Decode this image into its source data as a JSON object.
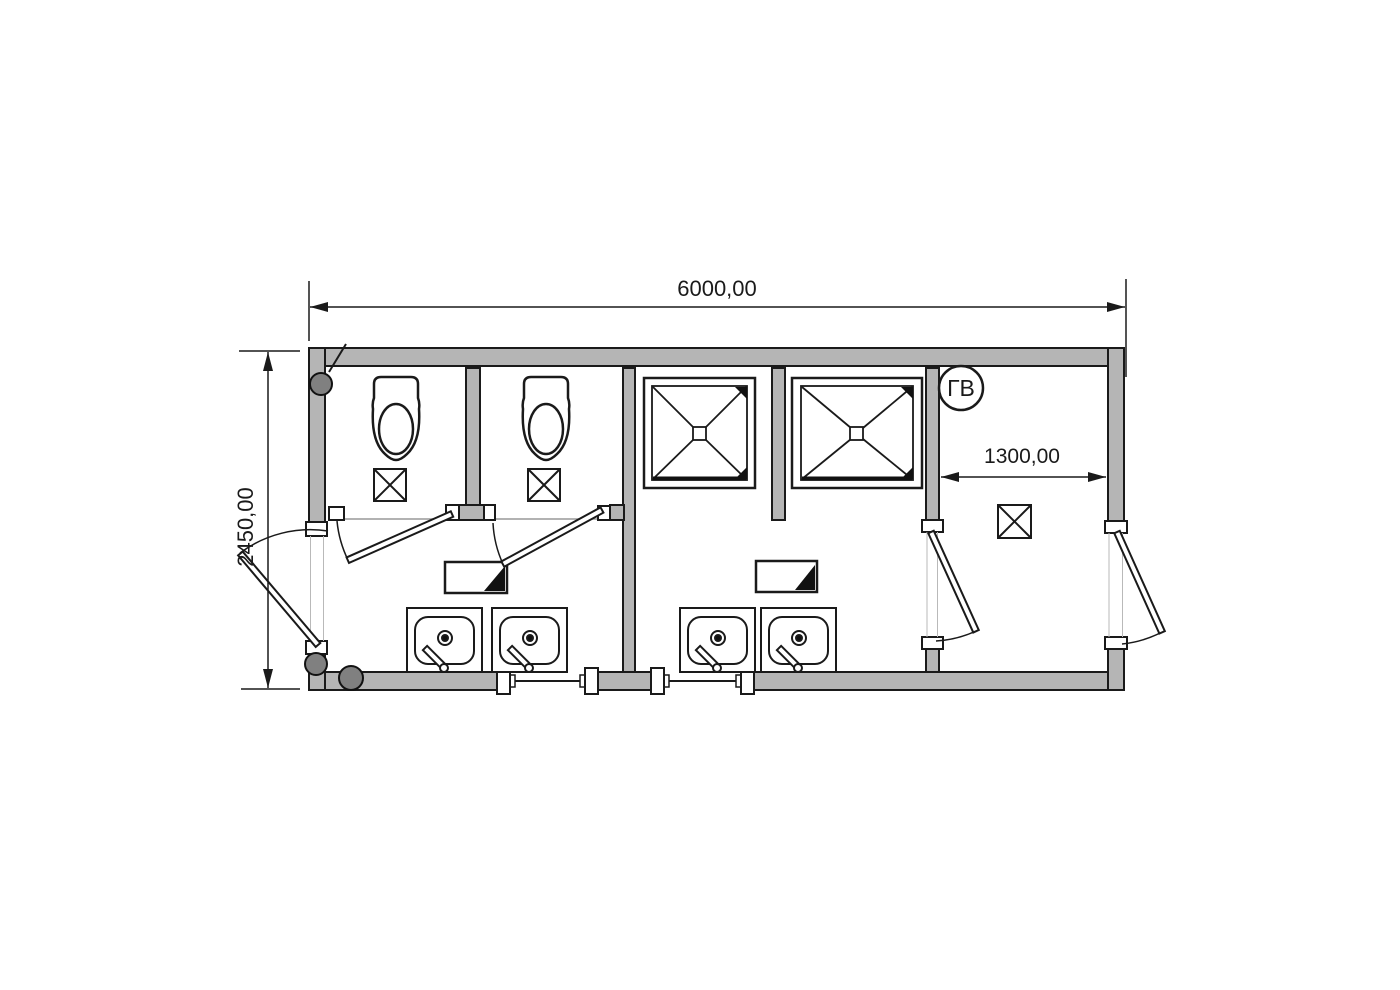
{
  "drawing": {
    "kind": "sanitary-container-floor-plan",
    "wall_fill": "#b5b5b5",
    "line_color": "#1a1a1a",
    "background": "#ffffff"
  },
  "dims": {
    "overall_width": "6000,00",
    "overall_depth": "2450,00",
    "right_room_width": "1300,00"
  },
  "labels": {
    "hot_water_riser": "ГВ"
  },
  "fixtures": {
    "toilets": 2,
    "toilet_floor_boxes": 2,
    "shower_trays": 2,
    "sinks": 4,
    "mirrors": 2,
    "right_room_floor_drain": 1,
    "pipe_risers": 3,
    "exterior_doors": 2,
    "interior_doors": 3
  }
}
